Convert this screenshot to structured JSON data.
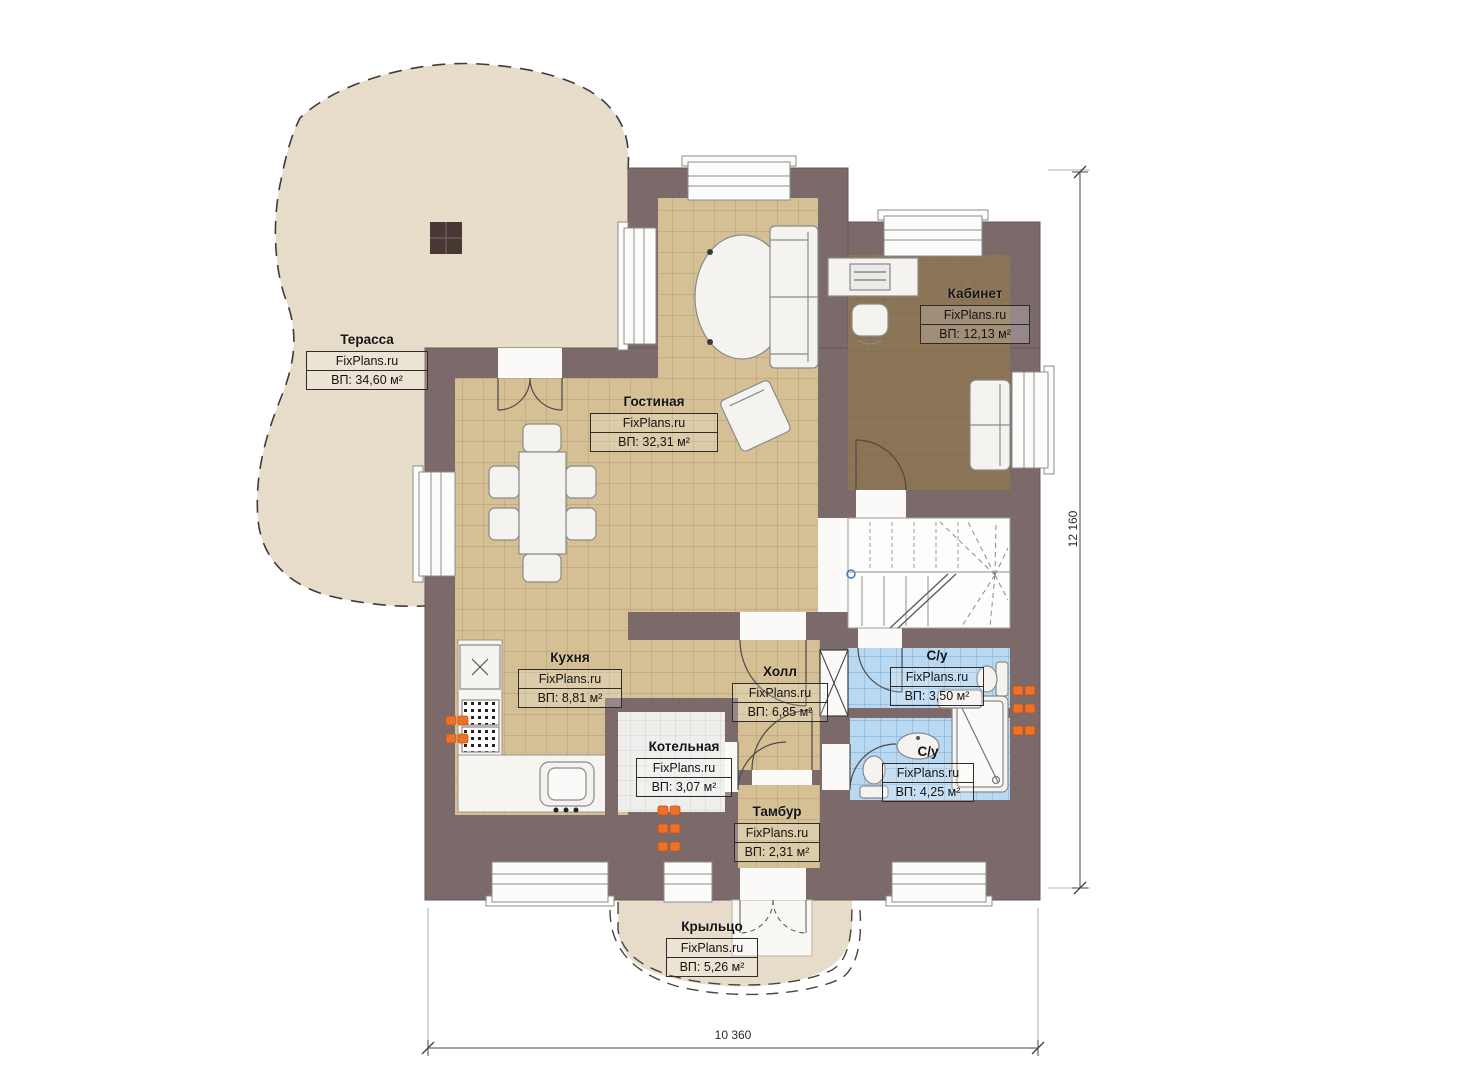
{
  "plan": {
    "brand_watermark": "FixPlans.ru",
    "rooms": [
      {
        "key": "terrace",
        "name": "Терасса",
        "watermark": "FixPlans.ru",
        "area": "ВП: 34,60 м²"
      },
      {
        "key": "living",
        "name": "Гостиная",
        "watermark": "FixPlans.ru",
        "area": "ВП: 32,31 м²"
      },
      {
        "key": "office",
        "name": "Кабинет",
        "watermark": "FixPlans.ru",
        "area": "ВП: 12,13 м²"
      },
      {
        "key": "kitchen",
        "name": "Кухня",
        "watermark": "FixPlans.ru",
        "area": "ВП: 8,81 м²"
      },
      {
        "key": "hall",
        "name": "Холл",
        "watermark": "FixPlans.ru",
        "area": "ВП: 6,85 м²"
      },
      {
        "key": "wc-upper",
        "name": "С/у",
        "watermark": "FixPlans.ru",
        "area": "ВП: 3,50 м²"
      },
      {
        "key": "wc-lower",
        "name": "С/у",
        "watermark": "FixPlans.ru",
        "area": "ВП: 4,25 м²"
      },
      {
        "key": "boiler",
        "name": "Котельная",
        "watermark": "FixPlans.ru",
        "area": "ВП: 3,07 м²"
      },
      {
        "key": "vestibule",
        "name": "Тамбур",
        "watermark": "FixPlans.ru",
        "area": "ВП: 2,31 м²"
      },
      {
        "key": "porch",
        "name": "Крыльцо",
        "watermark": "FixPlans.ru",
        "area": "ВП: 5,26 м²"
      }
    ],
    "dimensions": {
      "height_total": "12 160",
      "width_total": "10 360"
    },
    "colors": {
      "wall": "#7c6a6b",
      "floor_tan": "#d4c094",
      "floor_office": "#8c7457",
      "floor_bath": "#b9d8f1",
      "floor_boiler": "#efeeec",
      "terrace_fill": "#e7dcca",
      "furniture": "#f4f3f0",
      "radiator": "#ed7226"
    }
  }
}
